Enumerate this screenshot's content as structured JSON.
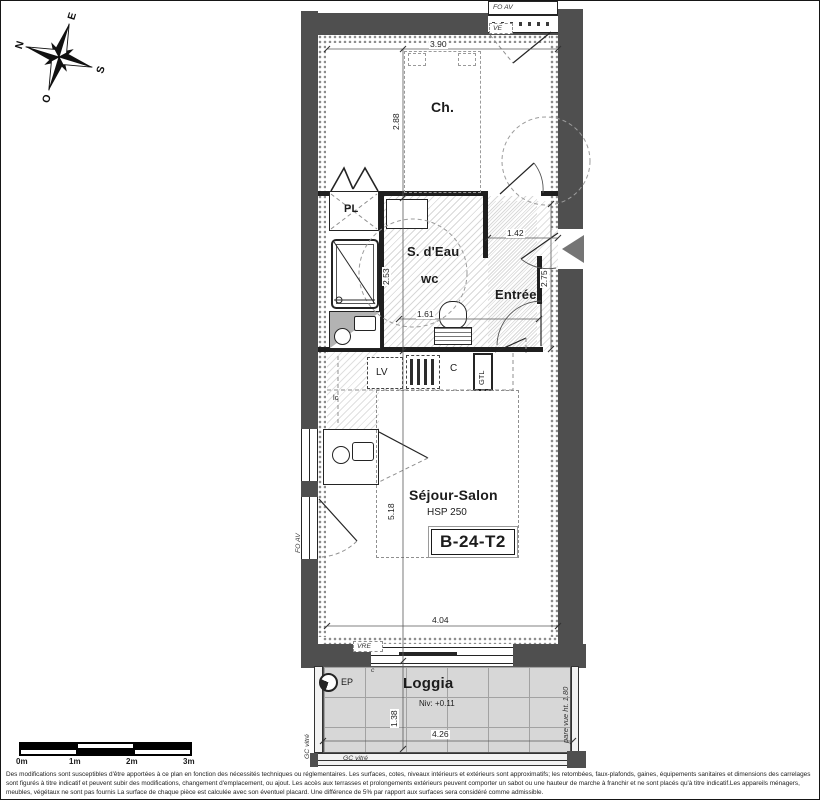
{
  "compass": {
    "north": "N",
    "east": "E",
    "south": "S",
    "west": "O"
  },
  "plan": {
    "unit_id": "B-24-T2",
    "rooms": {
      "bedroom": "Ch.",
      "bathroom": "S. d'Eau",
      "wc": "wc",
      "entry": "Entrée",
      "living": "Séjour-Salon",
      "living_ceiling_height": "HSP 250",
      "loggia": "Loggia",
      "loggia_level": "Niv: +0.11"
    },
    "fixtures": {
      "closet": "PL",
      "dishwasher": "LV",
      "cupboard": "C",
      "technical_duct": "GTL",
      "counter": "lc",
      "small_c": "c"
    },
    "window_labels": {
      "top_window": "FO AV",
      "left_window": "FO AV",
      "ve": "VE",
      "vre": "VRE"
    },
    "loggia_labels": {
      "rain_pipe": "EP",
      "railing_left": "GC vitré",
      "railing_bottom": "GC vitré",
      "privacy_screen": "pare vue ht. 1.80"
    },
    "dimensions": {
      "bedroom_width": "3.90",
      "bedroom_depth": "2.88",
      "entry_width": "1.42",
      "entry_depth": "2.75",
      "bathroom_depth": "2.53",
      "bathroom_width": "1.61",
      "living_depth": "5.18",
      "living_width": "4.04",
      "loggia_depth": "1.38",
      "loggia_width": "4.26"
    }
  },
  "scalebar": {
    "labels": [
      "0m",
      "1m",
      "2m",
      "3m"
    ]
  },
  "disclaimer": "Des modifications sont susceptibles d'être apportées à ce plan en fonction des nécessités techniques ou réglementaires. Les surfaces, cotes, niveaux intérieurs et extérieurs sont approximatifs; les retombées, faux-plafonds, gaines, équipements sanitaires et dimensions des carrelages sont figurés à titre indicatif et peuvent subir des modifications, changement d'emplacement, ou ajout. Les accès aux terrasses et prolongements extérieurs peuvent comporter un sabot ou une hauteur de marche à franchir et ne sont placés qu'à titre indicatif.Les appareils ménagers, meubles, végétaux ne sont pas fournis La surface de chaque pièce est calculée avec son éventuel placard. Une différence de 5% par rapport aux surfaces sera considéré comme admissible.",
  "colors": {
    "wall": "#4f4f4f",
    "partition": "#1f1f1f",
    "loggia_floor": "#d7d7d7"
  }
}
